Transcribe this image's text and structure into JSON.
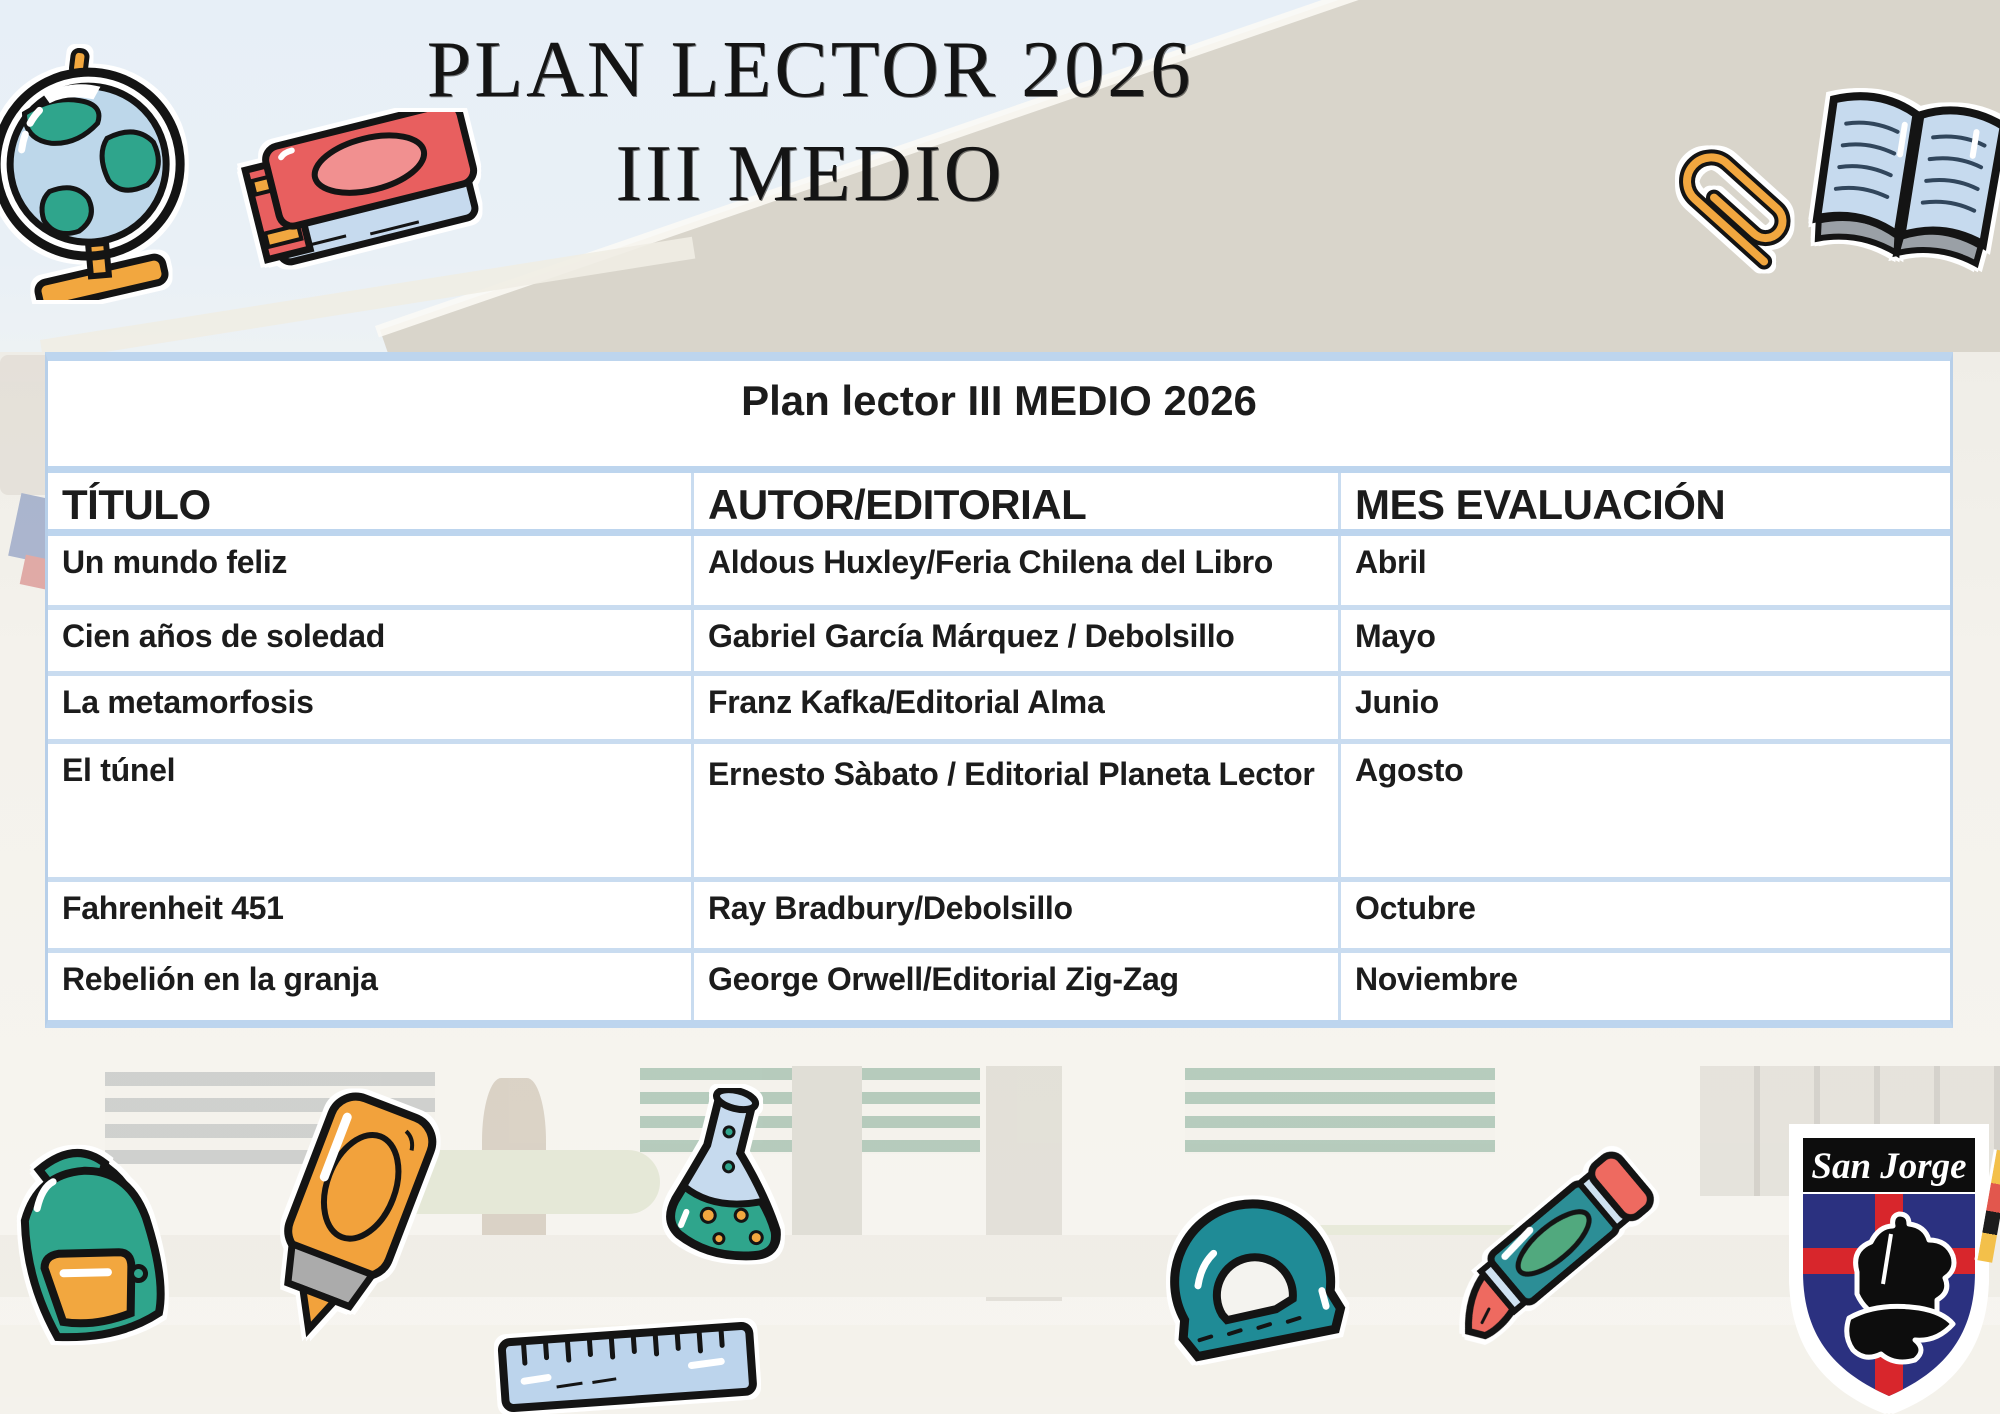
{
  "page": {
    "title_line1": "PLAN LECTOR 2026",
    "title_line2": "III MEDIO"
  },
  "table": {
    "title": "Plan lector III MEDIO 2026",
    "columns": [
      "TÍTULO",
      "AUTOR/EDITORIAL",
      "MES EVALUACIÓN"
    ],
    "rows": [
      {
        "titulo": "Un mundo feliz",
        "autor": "Aldous Huxley/Feria Chilena del Libro",
        "mes": "Abril"
      },
      {
        "titulo": "Cien años de soledad",
        "autor": "Gabriel García Márquez / Debolsillo",
        "mes": "Mayo"
      },
      {
        "titulo": "La metamorfosis",
        "autor": "Franz Kafka/Editorial Alma",
        "mes": "Junio"
      },
      {
        "titulo": "El túnel",
        "autor": "Ernesto Sàbato / Editorial Planeta Lector",
        "mes": "Agosto"
      },
      {
        "titulo": "Fahrenheit 451",
        "autor": "Ray Bradbury/Debolsillo",
        "mes": "Octubre"
      },
      {
        "titulo": "Rebelión en la granja",
        "autor": "George Orwell/Editorial Zig-Zag",
        "mes": "Noviembre"
      }
    ]
  },
  "crest": {
    "school_name": "San Jorge"
  },
  "decor": {
    "icons": [
      "globe-icon",
      "red-book-icon",
      "paperclip-icon",
      "open-book-icon",
      "backpack-icon",
      "highlighter-icon",
      "flask-icon",
      "ruler-icon",
      "protractor-icon",
      "crayon-icon",
      "school-crest"
    ]
  },
  "colors": {
    "table_border_blue": "#bdd5ee",
    "table_inner_blue": "#c9dcf0",
    "text": "#1c1c1c",
    "sticker_teal": "#2fa58c",
    "sticker_orange": "#f2a73f",
    "sticker_red": "#e85f5f",
    "sticker_lightblue": "#c6daee",
    "sticker_darkteal": "#1f8b96",
    "crest_navy": "#2b3180",
    "crest_red": "#d8262c"
  }
}
